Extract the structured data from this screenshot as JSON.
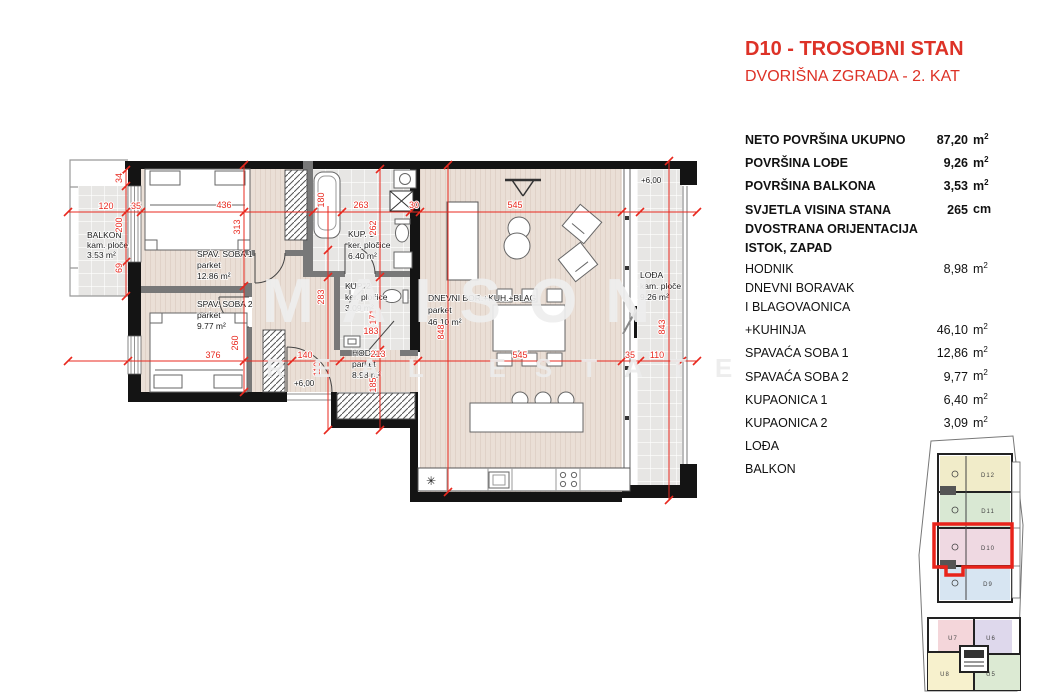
{
  "header": {
    "title": "D10 - TROSOBNI STAN",
    "subtitle": "DVORIŠNA ZGRADA - 2. KAT"
  },
  "summary": {
    "rows": [
      {
        "label": "NETO POVRŠINA UKUPNO",
        "value": "87,20",
        "unit": "m",
        "sup": "2"
      },
      {
        "label": "POVRŠINA LOĐE",
        "value": "9,26",
        "unit": "m",
        "sup": "2"
      },
      {
        "label": "POVRŠINA BALKONA",
        "value": "3,53",
        "unit": "m",
        "sup": "2"
      },
      {
        "label": "SVJETLA VISINA STANA",
        "value": "265",
        "unit": "cm",
        "sup": ""
      }
    ],
    "orientation": [
      "DVOSTRANA ORIJENTACIJA",
      "ISTOK, ZAPAD"
    ]
  },
  "rooms": [
    {
      "label": "HODNIK",
      "value": "8,98",
      "unit": "m",
      "sup": "2"
    },
    {
      "label": "DNEVNI BORAVAK",
      "value": "",
      "unit": "",
      "sup": ""
    },
    {
      "label": "I BLAGOVAONICA",
      "value": "",
      "unit": "",
      "sup": ""
    },
    {
      "label": "+KUHINJA",
      "value": "46,10",
      "unit": "m",
      "sup": "2"
    },
    {
      "label": "SPAVAĆA SOBA 1",
      "value": "12,86",
      "unit": "m",
      "sup": "2"
    },
    {
      "label": "SPAVAĆA SOBA 2",
      "value": "9,77",
      "unit": "m",
      "sup": "2"
    },
    {
      "label": "KUPAONICA 1",
      "value": "6,40",
      "unit": "m",
      "sup": "2"
    },
    {
      "label": "KUPAONICA 2",
      "value": "3,09",
      "unit": "m",
      "sup": "2"
    },
    {
      "label": "LOĐA",
      "value": "9,26",
      "unit": "m",
      "sup": "2"
    },
    {
      "label": "BALKON",
      "value": "3,53",
      "unit": "m",
      "sup": "2"
    }
  ],
  "plan": {
    "watermark1": "MAISON",
    "watermark2": "REAL ESTATE",
    "rooms": {
      "balkon": {
        "name": "BALKON",
        "floor": "kam. ploče",
        "area": "3.53 m²"
      },
      "soba1": {
        "name": "SPAV. SOBA 1",
        "floor": "parket",
        "area": "12.86 m²"
      },
      "soba2": {
        "name": "SPAV. SOBA 2",
        "floor": "parket",
        "area": "9.77 m²"
      },
      "kup1": {
        "name": "KUP. 1",
        "floor": "ker. pločice",
        "area": "6.40 m²"
      },
      "kup2": {
        "name": "KUP. 2",
        "floor": "ker. pločice",
        "area": "3.09 m²"
      },
      "hodnik": {
        "name": "HODNIK",
        "floor": "parket",
        "area": "8.98 m²"
      },
      "dnevni": {
        "name": "DNEVNI BOR.+KUH.+BLAG",
        "floor": "parket",
        "area": "46.10 m²"
      },
      "lodja": {
        "name": "LOĐA",
        "floor": "kam. ploče",
        "area": "9.26 m²"
      }
    },
    "levels": {
      "hodnik": "+6,00",
      "lodja": "+6,00"
    },
    "dims": {
      "top": [
        "120",
        "35",
        "436",
        "263",
        "30",
        "545"
      ],
      "bottom": [
        "376",
        "140",
        "213",
        "545",
        "35",
        "110"
      ],
      "left": [
        "34",
        "200",
        "69"
      ],
      "vert": [
        "180",
        "313",
        "260",
        "283",
        "110",
        "262",
        "171",
        "183",
        "185",
        "848",
        "843"
      ]
    }
  },
  "siteplan": {
    "upper": [
      {
        "id": "D12"
      },
      {
        "id": "D11"
      },
      {
        "id": "D10"
      },
      {
        "id": "D9"
      }
    ],
    "lower": [
      {
        "id": "U7"
      },
      {
        "id": "U6"
      },
      {
        "id": "U8"
      },
      {
        "id": "U5"
      }
    ]
  },
  "colors": {
    "accent": "#DD3227",
    "dimension_red": "#E8291F",
    "parquet": "#EADFD6",
    "tile": "#E7E6E4",
    "wall": "#141414",
    "site_highlight": "#E8231A",
    "unit_d12": "#F1ECC9",
    "unit_d11": "#D9E8D3",
    "unit_d10": "#EFD9E2",
    "unit_d9": "#D7E5F2",
    "unit_u7": "#F4D6DA",
    "unit_u6": "#DED8EC",
    "unit_u8": "#F7F1CD",
    "unit_u5": "#DCEAD3"
  }
}
